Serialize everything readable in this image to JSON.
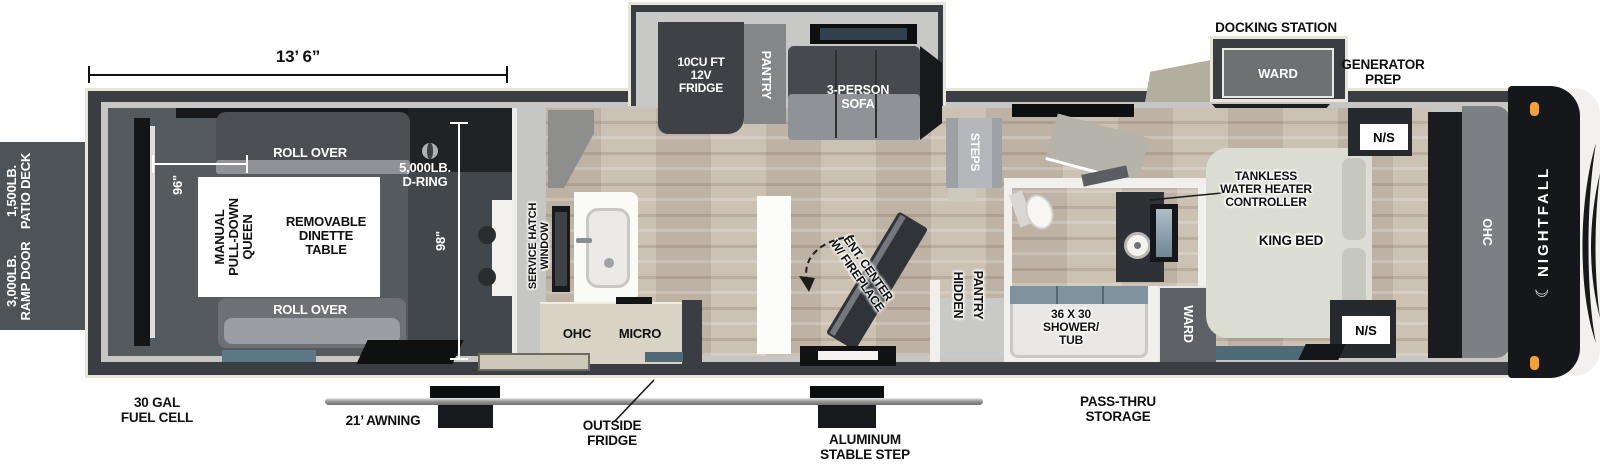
{
  "brand": {
    "name": "NIGHTFALL",
    "moon_icon": "☾"
  },
  "dimensions": {
    "garage_length": "13’ 6”",
    "garage_width": "96\"",
    "body_width": "98\""
  },
  "exterior": {
    "patio_deck": "1,500LB.\nPATIO DECK",
    "ramp_door": "3,000LB.\nRAMP DOOR",
    "fuel_cell": "30 GAL\nFUEL CELL",
    "awning": "21’ AWNING",
    "outside_fridge": "OUTSIDE\nFRIDGE",
    "stable_step": "ALUMINUM\nSTABLE STEP",
    "pass_thru": "PASS-THRU\nSTORAGE",
    "docking_station": "DOCKING STATION",
    "generator_prep": "GENERATOR\nPREP"
  },
  "garage": {
    "sofa_top": "ROLL OVER",
    "sofa_bottom": "ROLL OVER",
    "queen_bed": "MANUAL\nPULL-DOWN\nQUEEN",
    "dinette": "REMOVABLE\nDINETTE\nTABLE",
    "d_ring": "5,000LB.\nD-RING"
  },
  "kitchen": {
    "service_hatch": "SERVICE HATCH\nWINDOW",
    "ohc": "OHC",
    "micro": "MICRO",
    "fridge": "10CU FT\n12V\nFRIDGE",
    "pantry": "PANTRY",
    "sofa": "3-PERSON\nSOFA",
    "ent_center": "ENT. CENTER\nW/ FIREPLACE",
    "hidden_pantry": [
      "HIDDEN",
      "PANTRY"
    ],
    "steps": "STEPS"
  },
  "bath": {
    "shower_tub": "36 X 30\nSHOWER/\nTUB"
  },
  "bedroom": {
    "king_bed": "KING BED",
    "tankless": "TANKLESS\nWATER HEATER\nCONTROLLER",
    "night_stand_top": "N/S",
    "night_stand_bottom": "N/S",
    "ward_slide": "WARD",
    "ward_closet": "WARD",
    "ohc": "OHC"
  },
  "colors": {
    "wall_dark": "#3a3d41",
    "trim_cream": "#e9e5d9",
    "floor_wood": "#c7bcad",
    "garage_floor": "#545a5e",
    "accent_teal": "#54707d",
    "marker_orange": "#f0a23c",
    "cap_black": "#15171a"
  }
}
